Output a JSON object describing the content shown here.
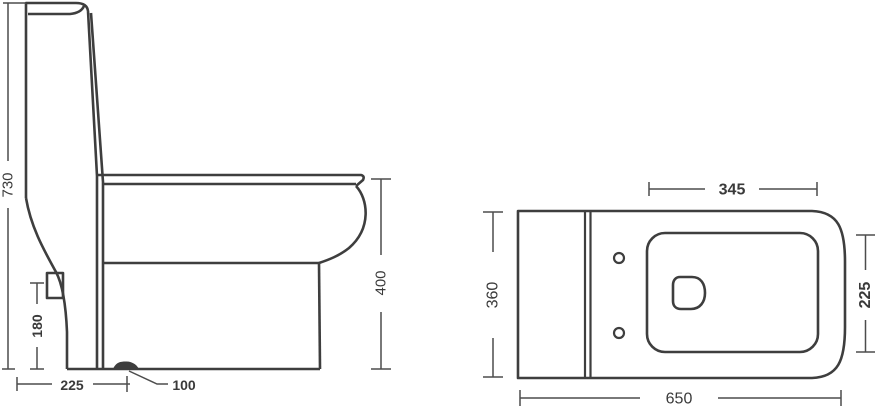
{
  "colors": {
    "outline": "#3e3e3e",
    "dimension_line": "#4d4d4d",
    "text": "#3a3a3a",
    "background": "#ffffff"
  },
  "side_view": {
    "dimensions": {
      "overall_height": "730",
      "inlet_height": "180",
      "outlet_setout": "225",
      "outlet_size": "100",
      "rim_height": "400"
    }
  },
  "top_view": {
    "dimensions": {
      "seat_opening_width": "345",
      "body_depth": "360",
      "seat_opening_depth": "225",
      "overall_length": "650"
    }
  }
}
